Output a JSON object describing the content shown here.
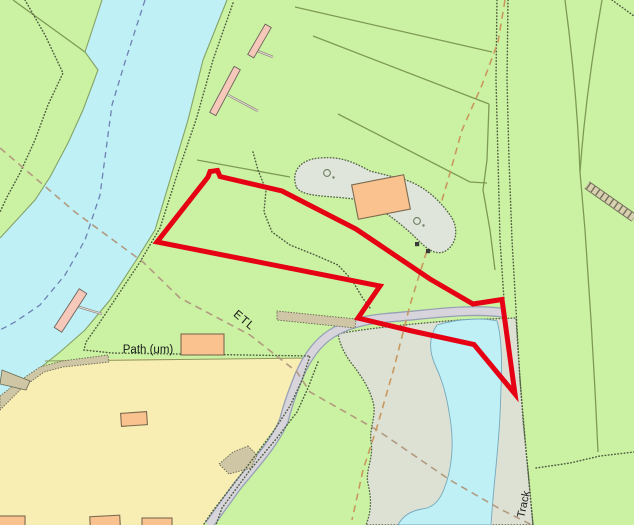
{
  "map": {
    "type": "ordnance-survey-style-extract",
    "labels": {
      "etl": "ETL",
      "path_um": "Path (um)",
      "track": "Track"
    },
    "legend_semantics": {
      "red_outline": "site-boundary",
      "cyan_areas": "water (river and pond)",
      "yellow_area": "field parcel",
      "grey_green_areas": "rough grassland / scrub",
      "orange_shapes": "buildings",
      "pink_shapes": "jetties with footbridges",
      "grey_ribbon": "road / track",
      "dashed_orange_lines": "overhead electricity transmission line / boundary",
      "dashed_blue_line": "river navigation centreline",
      "dotted_lines": "paths and vegetation limits",
      "ladder_symbol": "steps",
      "tree_symbols": 2,
      "post_symbols": 2
    },
    "colors": {
      "grass_green": "#cbf2a2",
      "water_cyan": "#bff0f6",
      "field_yellow": "#f8edb3",
      "rough_grey_green": "#dce1d3",
      "scrub_grey": "#dfe5da",
      "road_fill": "#d7d4db",
      "road_casing": "#97a1b5",
      "tan_track": "#cfc6a6",
      "building_orange": "#f9c28f",
      "jetty_pink": "#f5c8ba",
      "boundary_red": "#e60014",
      "field_line_olive": "#7d9a55",
      "dot_line_dark": "#4f5f42",
      "dash_orange": "#c9985e",
      "dash_etl": "#b29a80",
      "dash_blue": "#6e82b4"
    }
  }
}
